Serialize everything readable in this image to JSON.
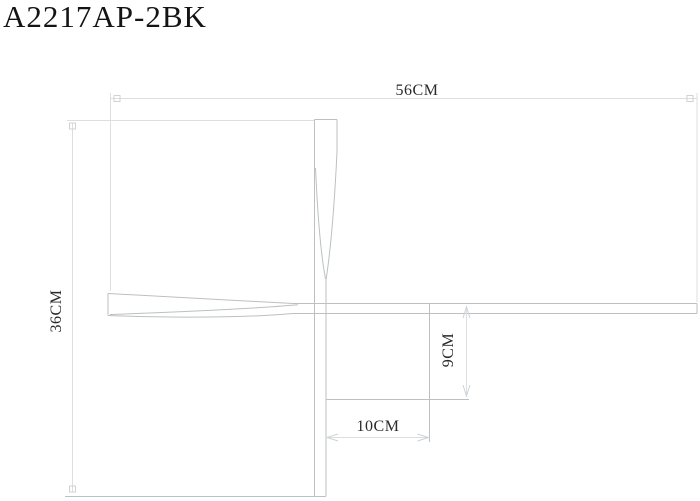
{
  "title": "A2217AP-2BK",
  "drawing": {
    "type": "technical-dimension-drawing",
    "dimensions": {
      "overall_width": {
        "label": "56CM"
      },
      "overall_height": {
        "label": "36CM"
      },
      "plate_height": {
        "label": "9CM"
      },
      "plate_width": {
        "label": "10CM"
      }
    }
  },
  "colors": {
    "background": "#ffffff",
    "title_text": "#141414",
    "dimension_text": "#2a2a2a",
    "object_line": "#bcc0c2",
    "dimension_line": "#dbdfe1",
    "marker_line": "#ced2d4"
  }
}
